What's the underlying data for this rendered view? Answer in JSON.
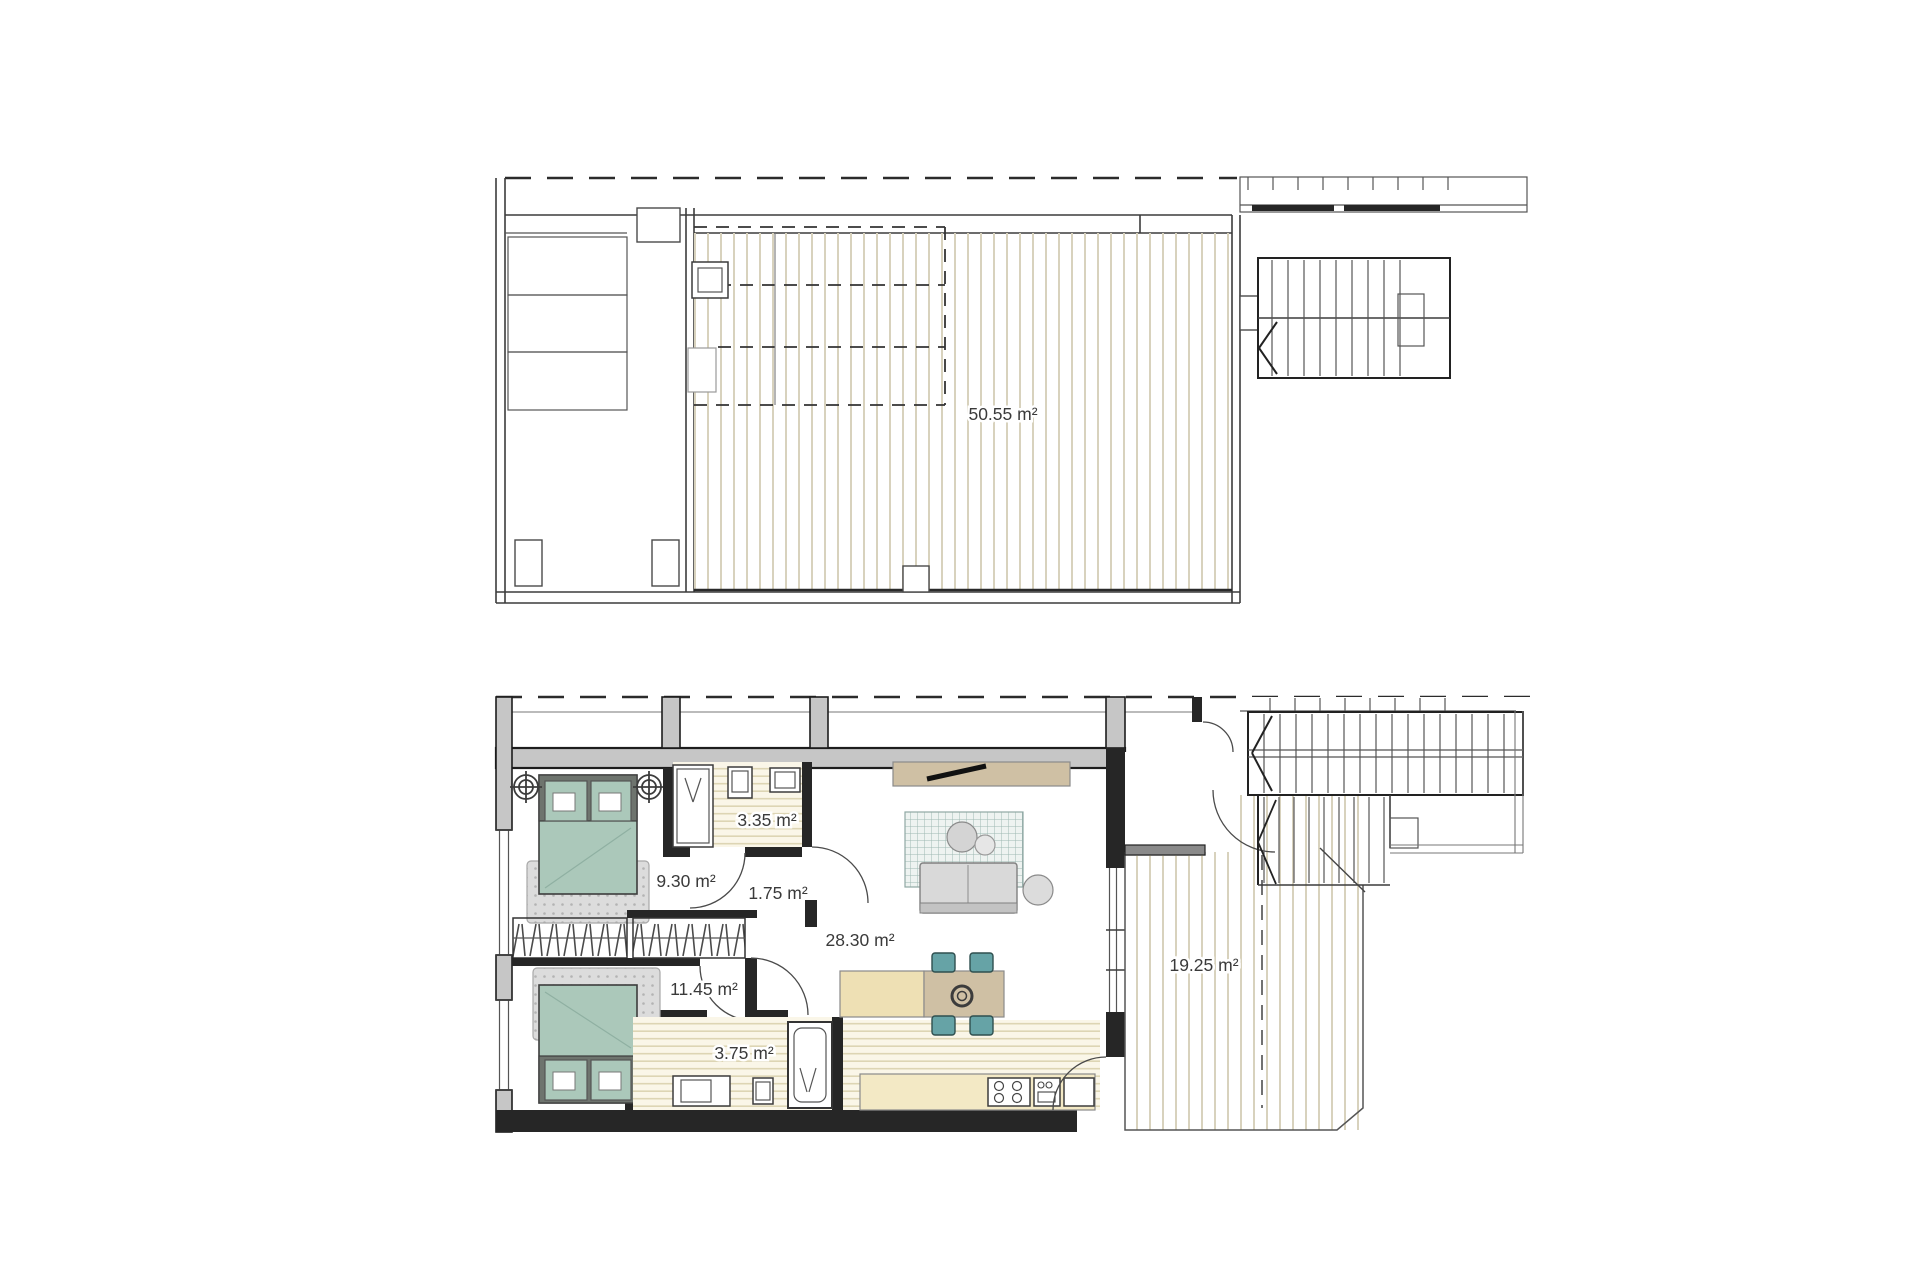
{
  "plans": {
    "upper": {
      "title": "upper-floor-plan",
      "rooms": [
        {
          "id": "roof-terrace",
          "area_label": "50.55 m²"
        }
      ]
    },
    "lower": {
      "title": "main-floor-plan",
      "rooms": [
        {
          "id": "bedroom-1",
          "area_label": "9.30 m²"
        },
        {
          "id": "dressing-room",
          "area_label": "3.35 m²"
        },
        {
          "id": "hall",
          "area_label": "1.75 m²"
        },
        {
          "id": "living-kitchen",
          "area_label": "28.30 m²"
        },
        {
          "id": "bedroom-2",
          "area_label": "11.45 m²"
        },
        {
          "id": "bathroom",
          "area_label": "3.75 m²"
        },
        {
          "id": "terrace",
          "area_label": "19.25 m²"
        }
      ]
    }
  },
  "colors": {
    "deck_stripe": "#d8d2bd",
    "tile_bg": "#faf6e8",
    "tile_stripe": "#ddd5b4",
    "bed_green": "#abc8ba",
    "bed_frame": "#6e746e",
    "rug_grey": "#dcdcdc",
    "sofa_grey": "#d9d9d9",
    "wood_tan": "#cfc0a4",
    "counter_beige": "#f3e9c5",
    "island_beige": "#eee0b4",
    "chair_teal": "#66a3a6",
    "wall_grey": "#c6c6c6",
    "label_color": "#3a3a3a"
  }
}
